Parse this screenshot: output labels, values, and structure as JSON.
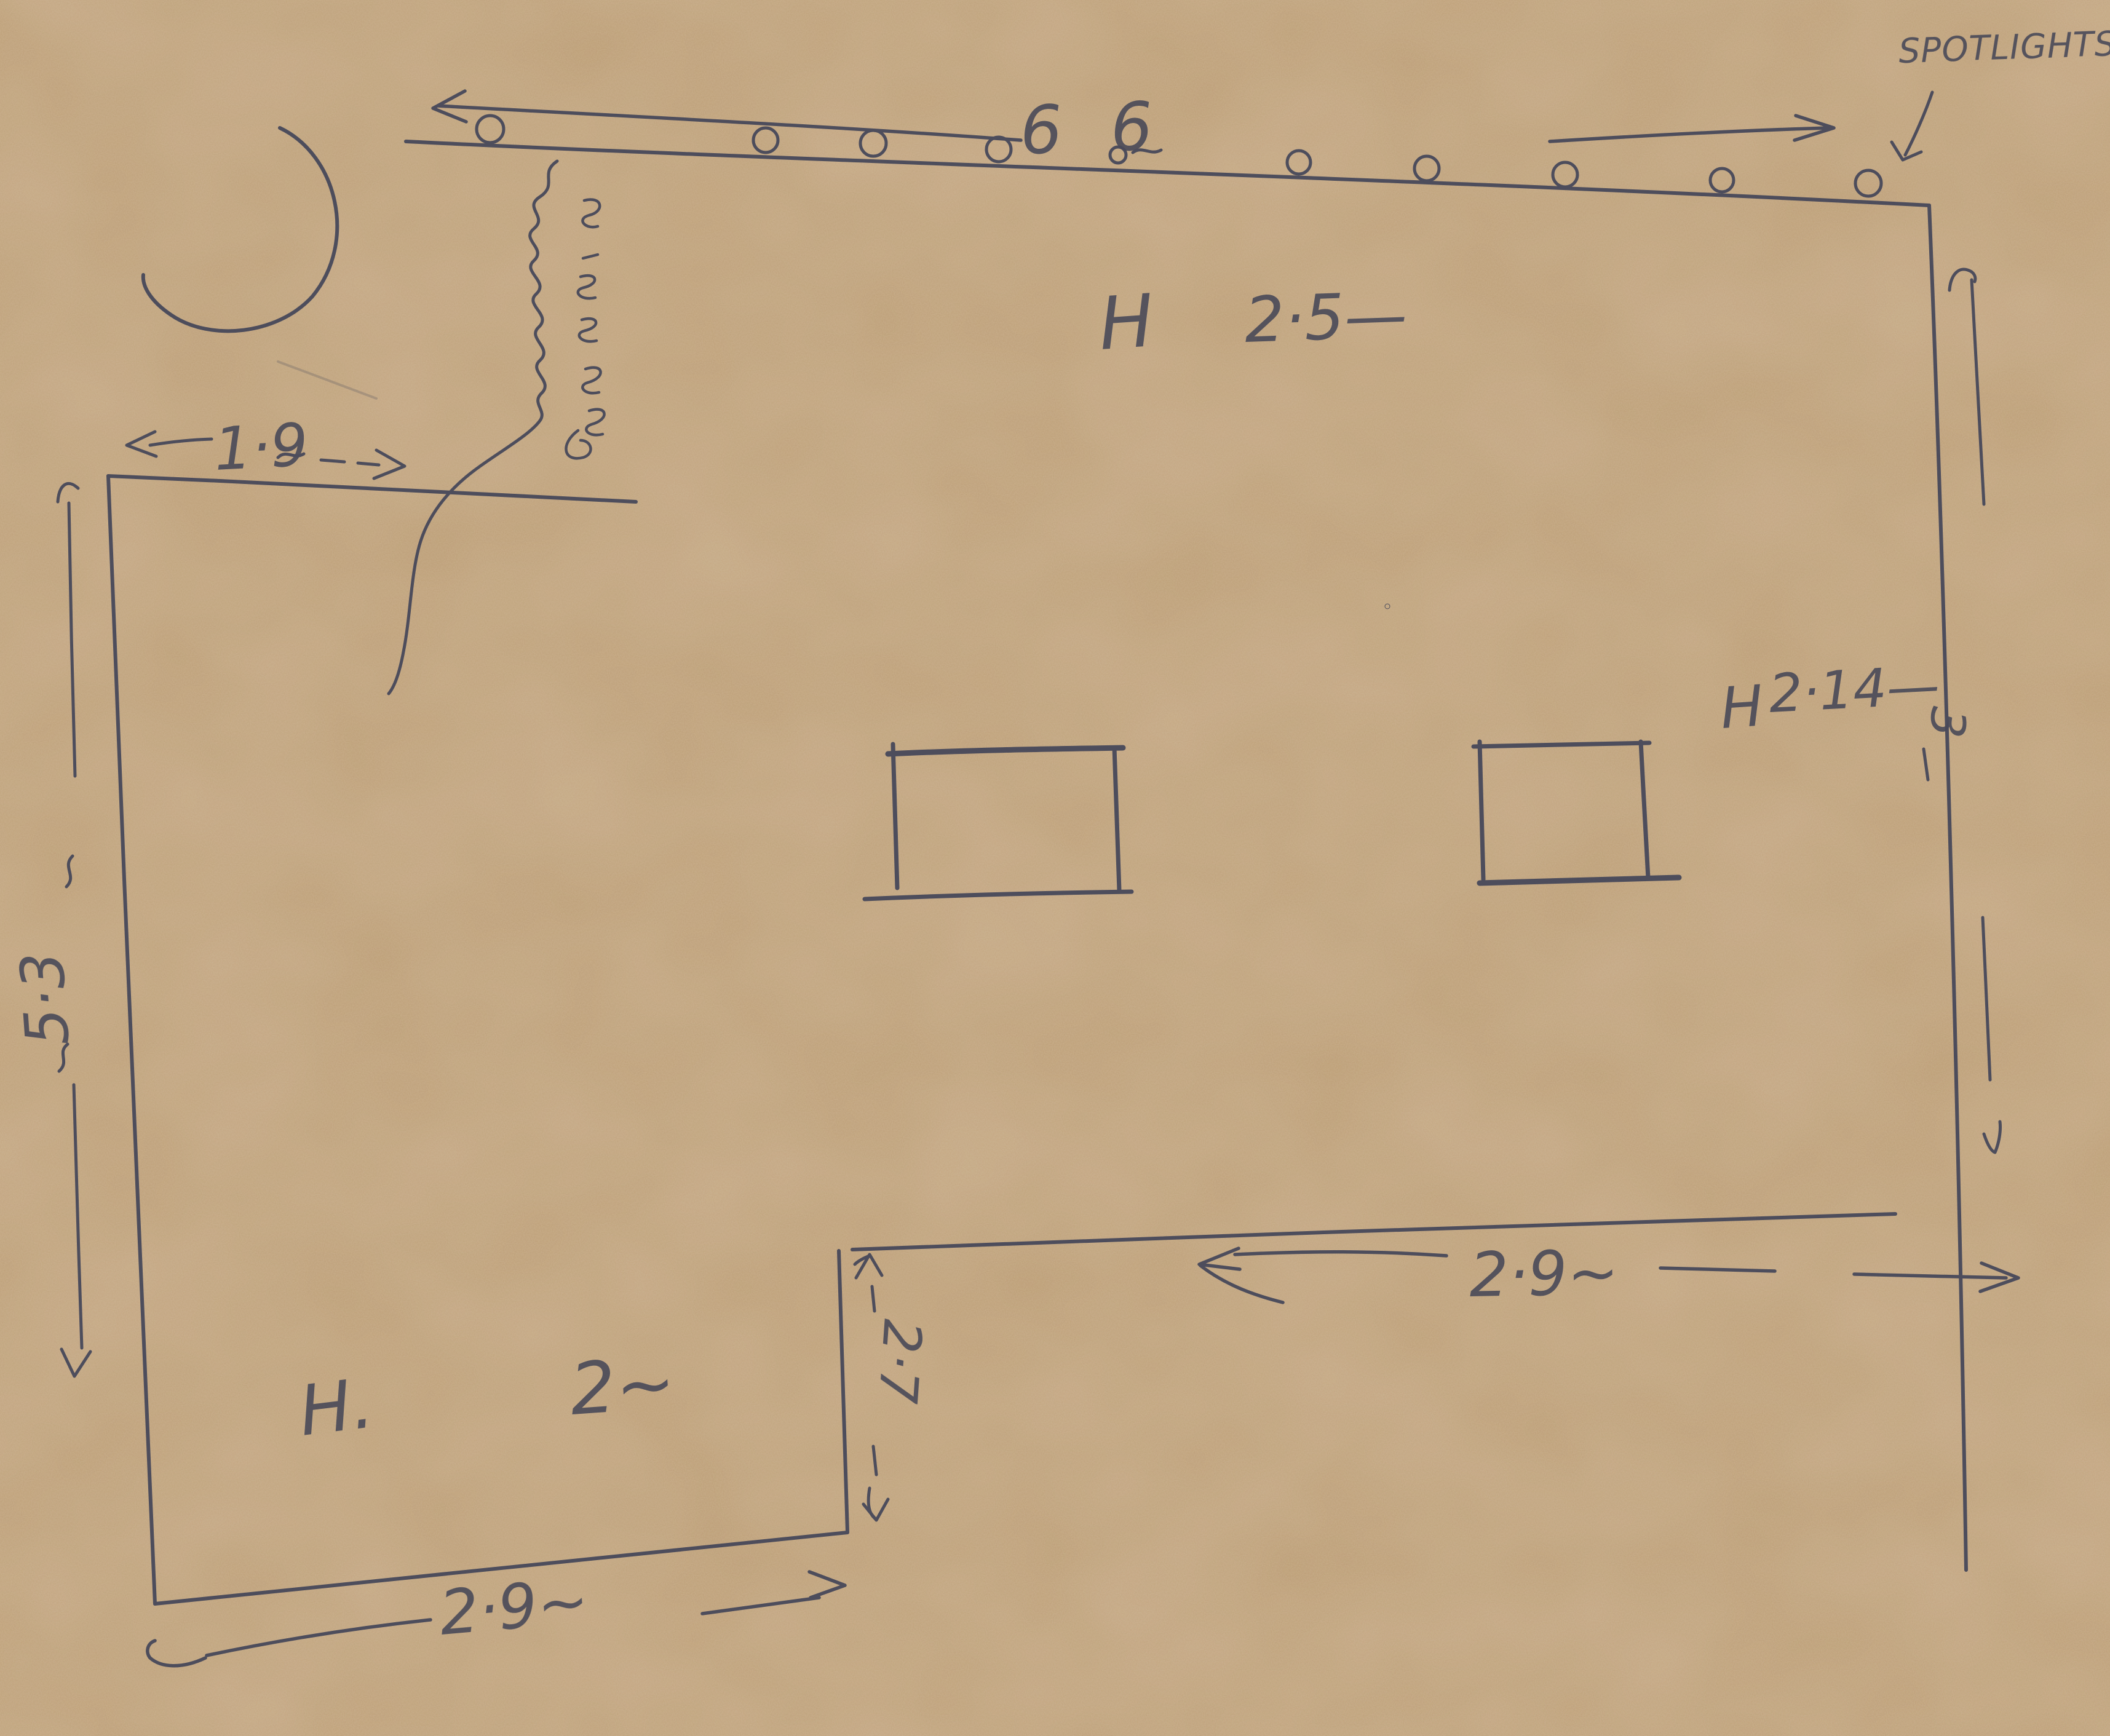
{
  "scene": {
    "description": "Hand-drawn floor plan sketch in blue ballpoint pen on brown kraft paper",
    "paper_colors": {
      "base": "#b69877",
      "light": "#ccb18e",
      "dark": "#a08260"
    },
    "ink_color": "#3a3e56"
  },
  "labels": {
    "spotlights": "SPOTLIGHTS",
    "track_numbers": "6 6",
    "ceiling_height_top": {
      "prefix": "H",
      "value": "2·5—"
    },
    "ceiling_height_right": {
      "prefix": "H",
      "value": "2·14—"
    },
    "ceiling_height_left_room": {
      "prefix": "H.",
      "value": "2~"
    },
    "width_top_left": "1·9",
    "width_middle": "2·9~",
    "width_bottom": "2·9~",
    "step_depth": "2·7",
    "left_wall_span": "5·3",
    "right_wall_span": "3"
  },
  "measurements": [
    {
      "name": "spotlight-wall height",
      "value": 2.5
    },
    {
      "name": "right-wall height",
      "value": 2.14
    },
    {
      "name": "left-room height",
      "value": 2
    },
    {
      "name": "top-left wall width",
      "value": 1.9
    },
    {
      "name": "middle wall width",
      "value": 2.9
    },
    {
      "name": "bottom wall width",
      "value": 2.9
    },
    {
      "name": "inner step depth",
      "value": 2.7
    },
    {
      "name": "left wall length",
      "value": 5.3
    },
    {
      "name": "right side span",
      "value": 3
    },
    {
      "name": "spotlight count marks",
      "value": "6 6"
    }
  ],
  "features": {
    "spotlight_circles": 9,
    "small_circle_after_6": 1,
    "inner_rectangles": 2,
    "curved_alcove": 1,
    "wavy_divider_with_illegible_vertical_scribble": 1
  }
}
